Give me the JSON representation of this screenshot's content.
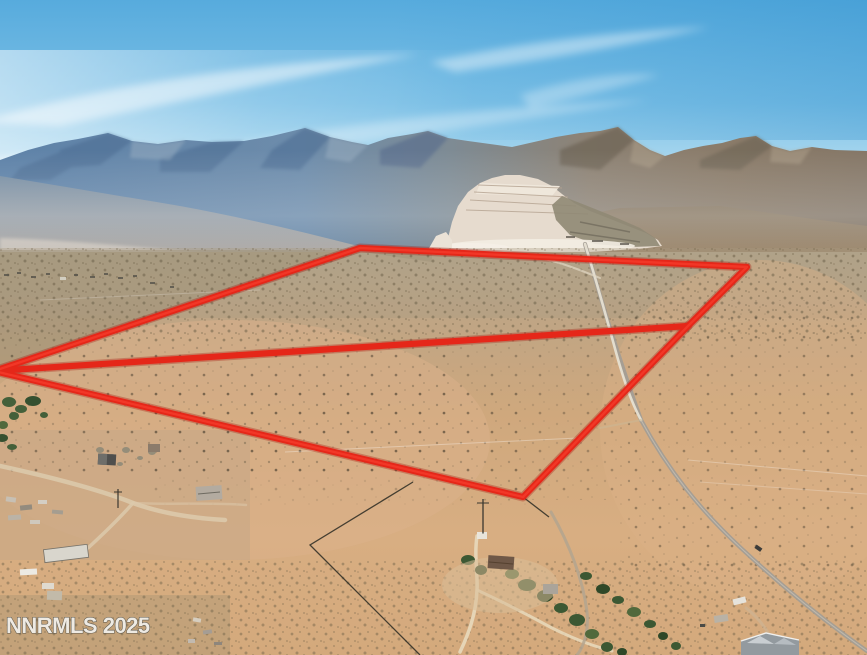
{
  "photo": {
    "watermark": "NNRMLS 2025",
    "description": "Aerial drone photo of high-desert acreage with mountain backdrop, mined hillside, dirt roads and rural homes; red property-boundary overlay outlines two adjoining parcels",
    "palette": {
      "sky_top": "#57abdd",
      "sky_horizon": "#dceef8",
      "mountain_blue": "#5e82a8",
      "mountain_brown": "#8a7b69",
      "quarry_light": "#e6dbce",
      "desert_tan": "#cfa87d",
      "road_gray": "#a39d94",
      "tree_green": "#44603a",
      "boundary_red": "#e52719",
      "watermark_fill": "#f2f1ec"
    }
  },
  "boundary": {
    "color": "#e52719",
    "glow_color": "rgba(165,18,8,0.32)",
    "outline_points": "-6,371 360,248 747,267 688,326 523,497 -6,371",
    "divider_points": "-6,371 688,326",
    "vertex_labels": [
      "left",
      "top",
      "right",
      "junction",
      "bottom"
    ],
    "unmarked_line1": "413,482 310,545 420,655",
    "unmarked_line2": "523,497 549,517"
  }
}
